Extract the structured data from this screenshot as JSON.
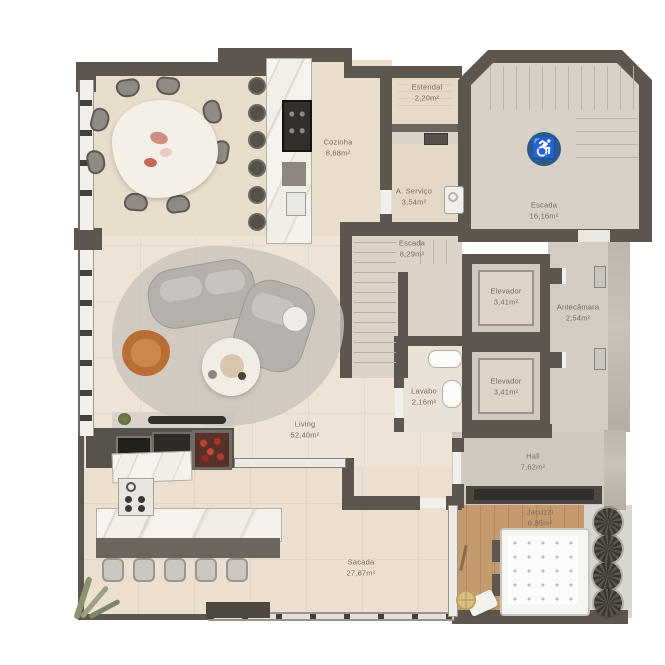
{
  "plan": {
    "background_color": "#ffffff",
    "wall_color": "#5c564f",
    "accent": {
      "accessibility_blue": "#2a5a85",
      "armchair_orange": "#b96f33",
      "grill_red": "#b23b2e",
      "deck_wood": "#c49a6e"
    },
    "accessibility_icon": "♿",
    "rooms": [
      {
        "id": "estendal",
        "name": "Estendal",
        "area": "2,20m²"
      },
      {
        "id": "cozinha",
        "name": "Cozinha",
        "area": "8,68m²"
      },
      {
        "id": "a-servico",
        "name": "A. Serviço",
        "area": "3,54m²"
      },
      {
        "id": "escada-principal",
        "name": "Escada",
        "area": "16,16m²"
      },
      {
        "id": "escada-interna",
        "name": "Escada",
        "area": "8,29m²"
      },
      {
        "id": "elevador-1",
        "name": "Elevador",
        "area": "3,41m²"
      },
      {
        "id": "antecamara",
        "name": "Antecâmara",
        "area": "2,54m²"
      },
      {
        "id": "elevador-2",
        "name": "Elevador",
        "area": "3,41m²"
      },
      {
        "id": "lavabo",
        "name": "Lavabo",
        "area": "2,16m²"
      },
      {
        "id": "living",
        "name": "Living",
        "area": "52,40m²"
      },
      {
        "id": "hall",
        "name": "Hall",
        "area": "7,62m²"
      },
      {
        "id": "jacuzzi",
        "name": "Jacuzzi",
        "area": "6,85m²"
      },
      {
        "id": "sacada",
        "name": "Sacada",
        "area": "27,87m²"
      }
    ]
  }
}
